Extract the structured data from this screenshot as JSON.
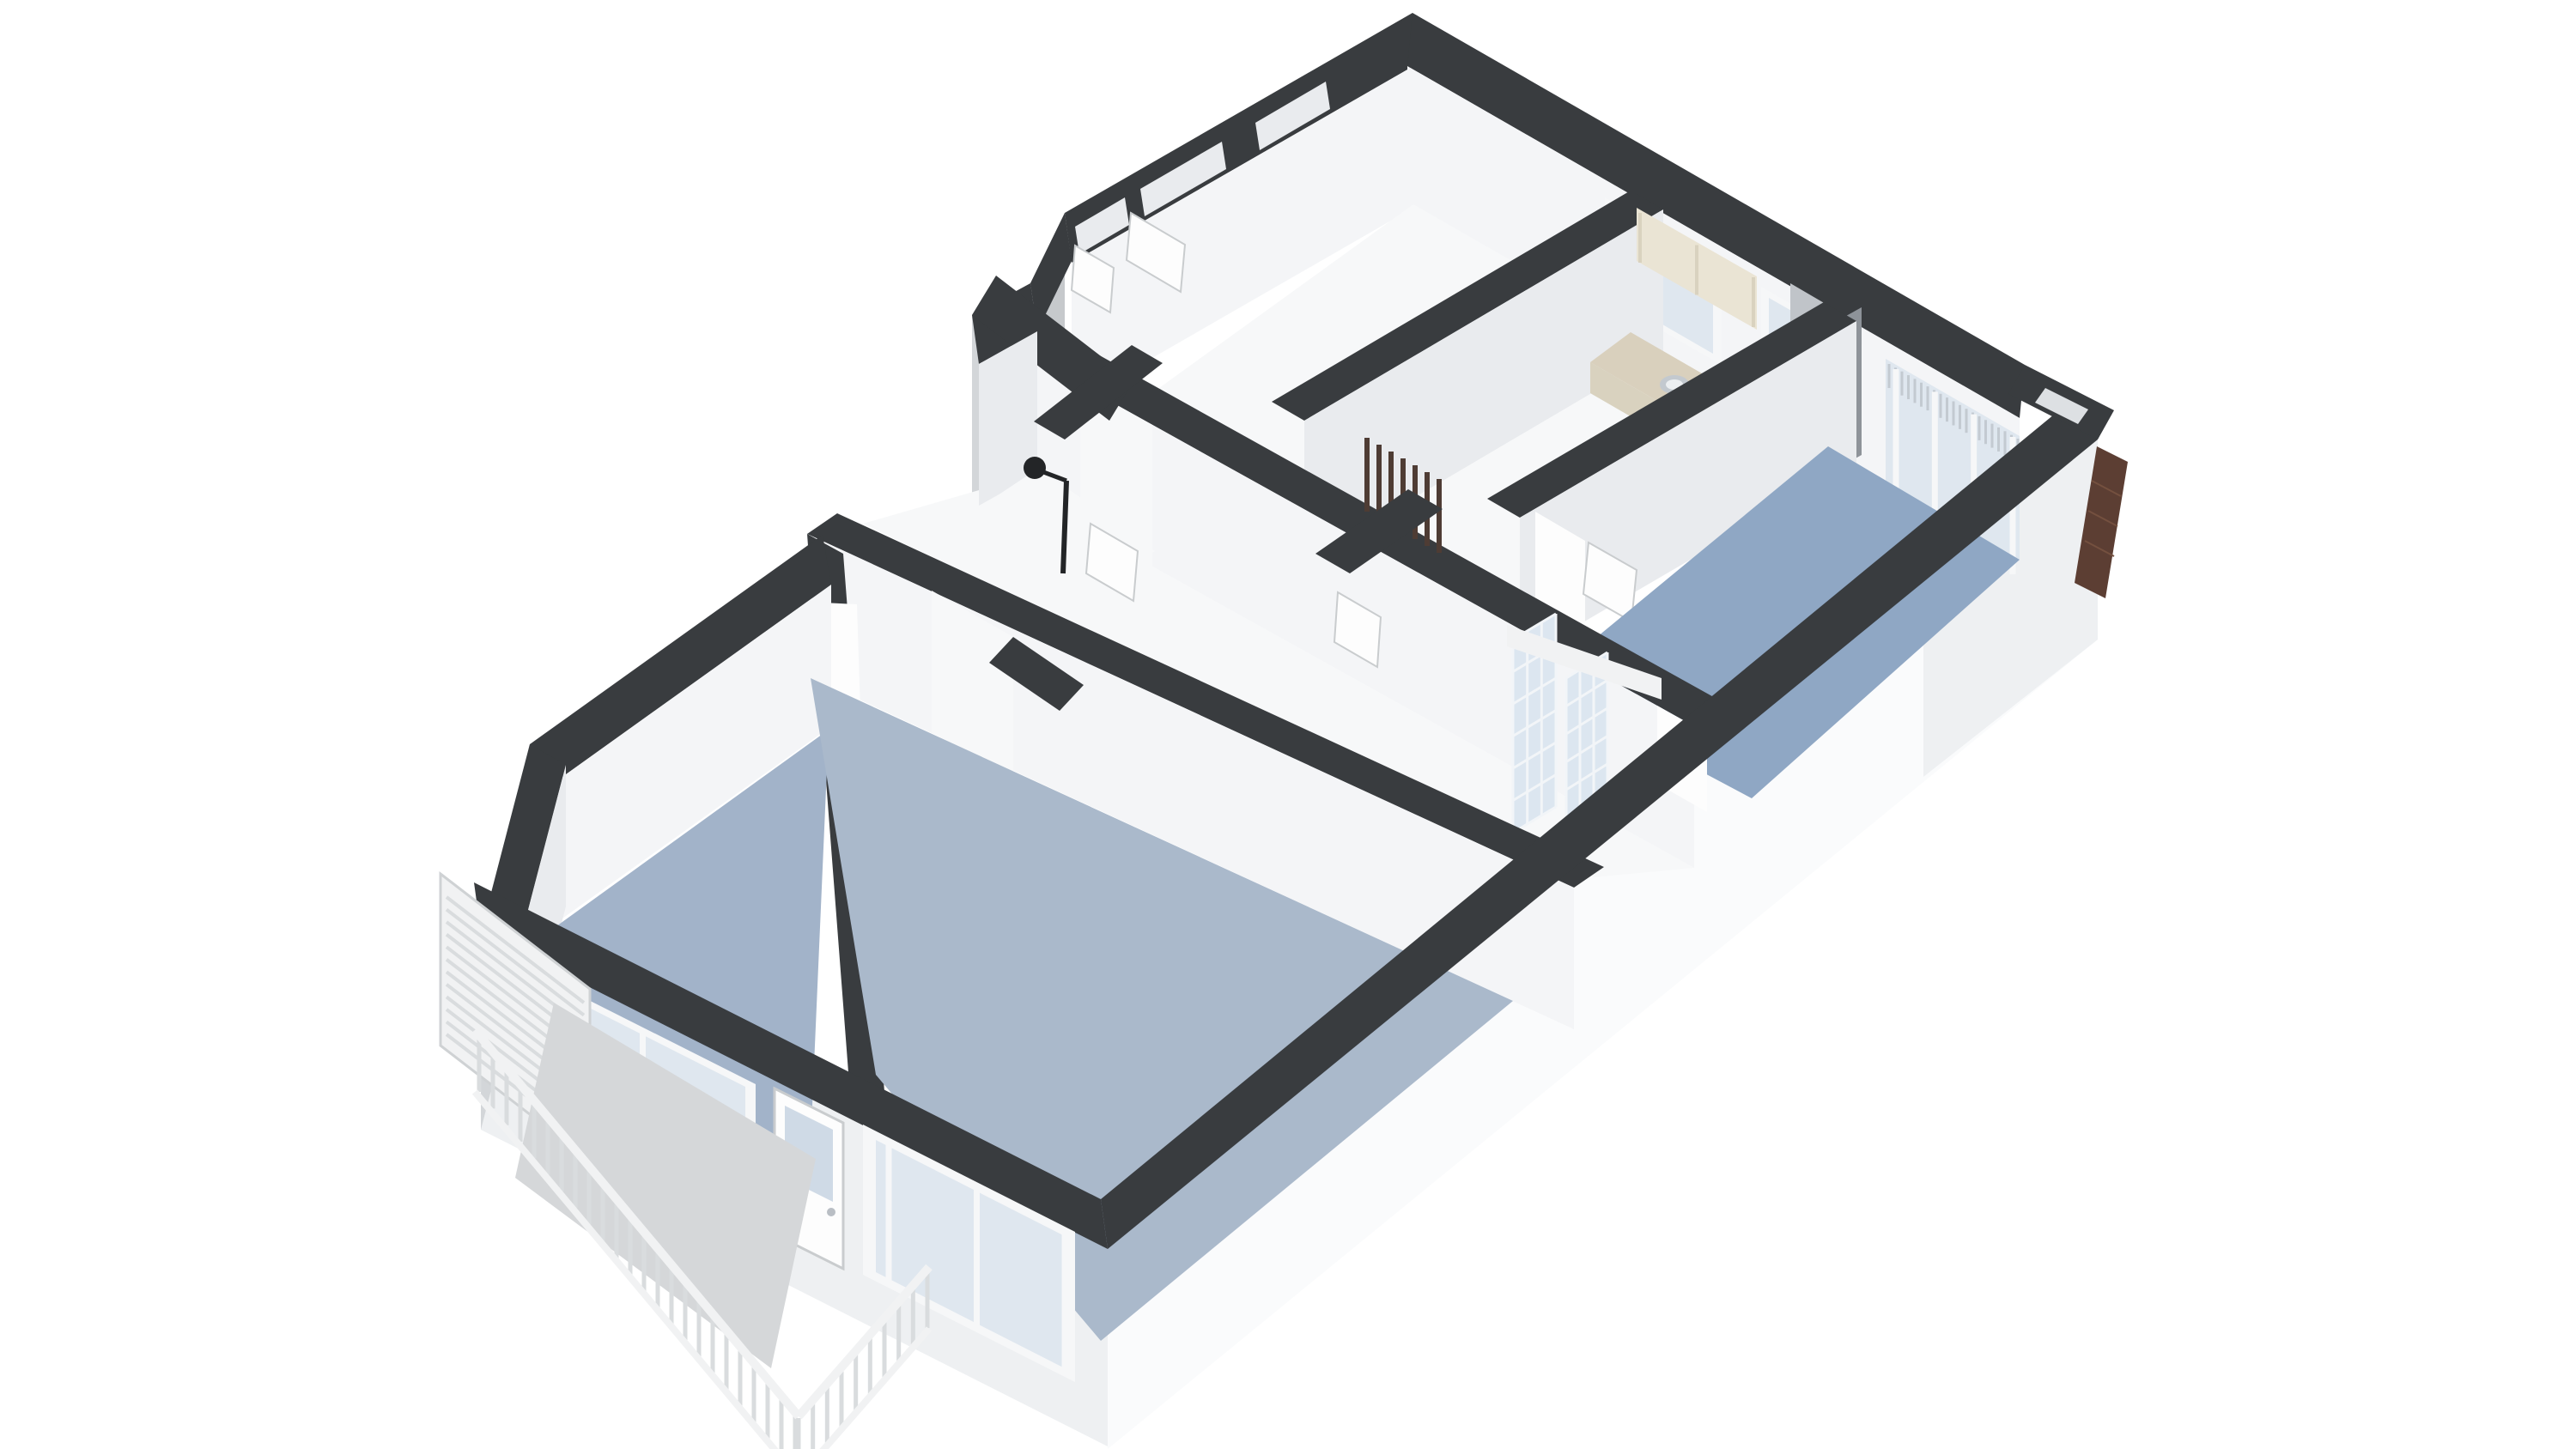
{
  "scene": {
    "type": "isometric-3d-floorplan-render",
    "background": "#ffffff",
    "view": "cutaway apartment floor plan seen from above at an angle, no text labels"
  },
  "colors": {
    "wall_top": "#393c3f",
    "wall_top_deep": "#303335",
    "wall_face": "#f4f5f7",
    "wall_face_soft": "#e9ebee",
    "wall_face_shadow": "#dde0e3",
    "skirt_bright": "#fafbfc",
    "skirt_light": "#eef0f2",
    "skirt_mid": "#d3d6d9",
    "skirt_deep": "#c6c9cc",
    "floor_light": "#f7f8f9",
    "floor_blue": "#8fa7c4",
    "floor_blue_soft": "#a2b3c9",
    "floor_blue_living": "#aab9cb",
    "glass": "#dfe7ef",
    "glass_dark": "#cfdae6",
    "frame_white": "#f6f7f8",
    "mullion_gray": "#b9bec4",
    "blind_stripe": "#c3cad1",
    "counter_top": "#d9d0bd",
    "cabinet_cream": "#eae4d4",
    "cabinet_shade": "#d9d2bf",
    "appliance": "#c0c4c9",
    "appliance_dark": "#8e9399",
    "hob": "#6e7276",
    "hob_ring": "#a7abaf",
    "radiator": "#4e3c34",
    "brick": "#5c3e33",
    "brick_line": "#74503f",
    "balcony_floor": "#d5d7d9",
    "railing": "#f1f2f3",
    "railing_shade": "#d9dcde",
    "shower_dark": "#232527",
    "glassblock_bg": "#dce6f0",
    "glassblock_grid": "#f2f5f8",
    "door_white": "#fdfdfd",
    "door_stroke": "#c9ccce",
    "sink_steel": "#c3c9cf",
    "sink_inner": "#eceff1"
  },
  "rooms": [
    {
      "id": "entrance-hall",
      "floor": "light"
    },
    {
      "id": "kitchen",
      "floor": "light"
    },
    {
      "id": "bedroom-right",
      "floor": "blue"
    },
    {
      "id": "shower-room",
      "floor": "light"
    },
    {
      "id": "hallway",
      "floor": "light"
    },
    {
      "id": "toilet",
      "floor": "light"
    },
    {
      "id": "bedroom-left",
      "floor": "blue-soft"
    },
    {
      "id": "living-room",
      "floor": "blue-living"
    },
    {
      "id": "balcony",
      "floor": "gray"
    }
  ],
  "features": [
    "entry-niches",
    "open-entry-doors",
    "hall-window",
    "kitchen-window",
    "kitchen-counter",
    "gas-hob",
    "kitchen-sink",
    "upper-cabinets",
    "refrigerator",
    "french-glazed-wall-bedroom-right",
    "vertical-blinds",
    "radiator",
    "glass-block-panels",
    "shower-fixture",
    "balcony-railing",
    "privacy-screen",
    "balcony-door",
    "bedroom-left-windows",
    "living-room-window",
    "brick-chimney-panel",
    "facade-notch"
  ],
  "generated": {
    "screen_slats": {
      "a": [
        520,
        1045
      ],
      "b": [
        520,
        1205
      ],
      "c": [
        680,
        1168
      ],
      "d": [
        680,
        1328
      ],
      "n": 11,
      "w": 4,
      "stroke": "railing_shade"
    },
    "rail_long_bal": {
      "a": [
        558,
        1205
      ],
      "b": [
        926,
        1650
      ],
      "c": [
        558,
        1272
      ],
      "d": [
        926,
        1717
      ],
      "n": 23,
      "w": 5,
      "stroke": "railing_shade"
    },
    "rail_return_bal": {
      "a": [
        930,
        1652
      ],
      "b": [
        1080,
        1480
      ],
      "c": [
        930,
        1719
      ],
      "d": [
        1080,
        1547
      ],
      "n": 9,
      "w": 5,
      "stroke": "railing_shade"
    },
    "glassblock1_v": {
      "a": [
        1762,
        745
      ],
      "b": [
        1812,
        715
      ],
      "c": [
        1762,
        970
      ],
      "d": [
        1812,
        940
      ],
      "n": 3,
      "w": 3,
      "stroke": "glassblock_grid"
    },
    "glassblock1_h": {
      "a": [
        1762,
        745
      ],
      "b": [
        1762,
        970
      ],
      "c": [
        1812,
        715
      ],
      "d": [
        1812,
        940
      ],
      "n": 6,
      "w": 3,
      "stroke": "glassblock_grid"
    },
    "glassblock2_v": {
      "a": [
        1824,
        790
      ],
      "b": [
        1872,
        760
      ],
      "c": [
        1824,
        985
      ],
      "d": [
        1872,
        955
      ],
      "n": 3,
      "w": 3,
      "stroke": "glassblock_grid"
    },
    "glassblock2_h": {
      "a": [
        1824,
        790
      ],
      "b": [
        1824,
        985
      ],
      "c": [
        1872,
        760
      ],
      "d": [
        1872,
        955
      ],
      "n": 6,
      "w": 3,
      "stroke": "glassblock_grid"
    },
    "blind_stripes": {
      "a": [
        2200,
        424
      ],
      "b": [
        2350,
        511
      ],
      "c": [
        2200,
        452
      ],
      "d": [
        2350,
        539
      ],
      "n": 20,
      "w": 3,
      "stroke": "blind_stripe"
    },
    "french_mullions": {
      "a": [
        2208,
        430
      ],
      "b": [
        2344,
        509
      ],
      "c": [
        2208,
        590
      ],
      "d": [
        2344,
        669
      ],
      "n": 3,
      "w": 7,
      "stroke": "frame_white"
    },
    "radiator_slats": {
      "a": [
        1592,
        510
      ],
      "b": [
        1676,
        558
      ],
      "c": [
        1592,
        596
      ],
      "d": [
        1676,
        644
      ],
      "n": 6,
      "w": 6,
      "stroke": "radiator"
    },
    "bigwin_mullions": {
      "a": [
        1035,
        1332
      ],
      "b": [
        1240,
        1436
      ],
      "c": [
        1035,
        1492
      ],
      "d": [
        1240,
        1596
      ],
      "n": 2,
      "w": 7,
      "stroke": "frame_white"
    },
    "bed2win_mullions": {
      "a": [
        625,
        1140
      ],
      "b": [
        872,
        1264
      ],
      "c": [
        625,
        1285
      ],
      "d": [
        872,
        1409
      ],
      "n": 2,
      "w": 7,
      "stroke": "frame_white"
    },
    "cabinet_seams": {
      "a": [
        1910,
        248
      ],
      "b": [
        2042,
        323
      ],
      "c": [
        1910,
        306
      ],
      "d": [
        2042,
        381
      ],
      "n": 2,
      "w": 4,
      "stroke": "cabinet_shade"
    }
  }
}
